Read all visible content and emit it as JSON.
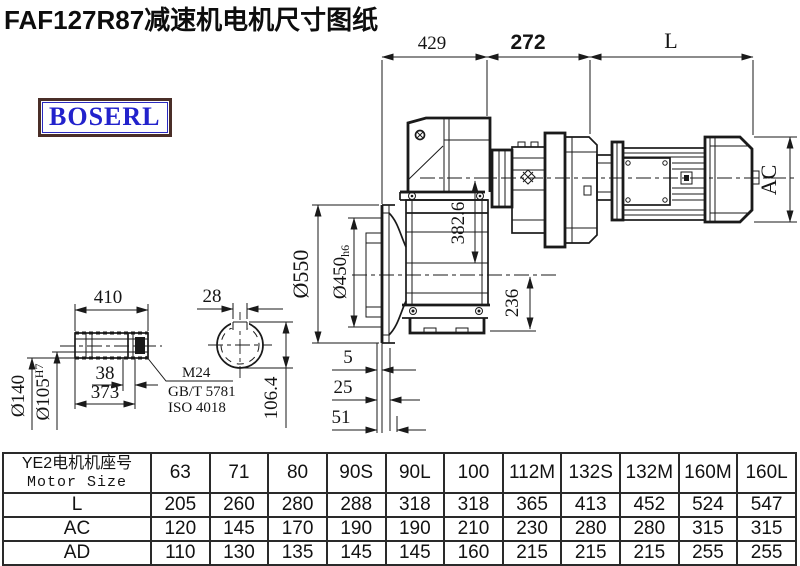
{
  "title": "FAF127R87减速机电机尺寸图纸",
  "logo": "BOSERL",
  "drawing": {
    "dim_429": "429",
    "dim_272": "272",
    "dim_L": "L",
    "dim_AC": "AC",
    "dim_382_6": "382.6",
    "dim_236": "236",
    "dim_550": "Ø550",
    "dim_450": "Ø450",
    "dim_450_tol": "h6",
    "dim_140": "Ø140",
    "dim_105": "Ø105",
    "dim_105_tol": "H7",
    "dim_410": "410",
    "dim_38": "38",
    "dim_373": "373",
    "dim_28": "28",
    "dim_106_4": "106.4",
    "dim_5": "5",
    "dim_25": "25",
    "dim_51": "51",
    "note_thread": "M24",
    "note_std1": "GB/T 5781",
    "note_std2": "ISO 4018"
  },
  "table": {
    "header_cn": "YE2电机机座号",
    "header_en": "Motor Size",
    "columns": [
      "63",
      "71",
      "80",
      "90S",
      "90L",
      "100",
      "112M",
      "132S",
      "132M",
      "160M",
      "160L"
    ],
    "rows": [
      {
        "label": "L",
        "values": [
          "205",
          "260",
          "280",
          "288",
          "318",
          "318",
          "365",
          "413",
          "452",
          "524",
          "547"
        ]
      },
      {
        "label": "AC",
        "values": [
          "120",
          "145",
          "170",
          "190",
          "190",
          "210",
          "230",
          "280",
          "280",
          "315",
          "315"
        ]
      },
      {
        "label": "AD",
        "values": [
          "110",
          "130",
          "135",
          "145",
          "145",
          "160",
          "215",
          "215",
          "215",
          "255",
          "255"
        ]
      }
    ]
  },
  "colors": {
    "line": "#1a1a1a",
    "logo_text": "#2222cc",
    "logo_border": "#4a2e28"
  }
}
